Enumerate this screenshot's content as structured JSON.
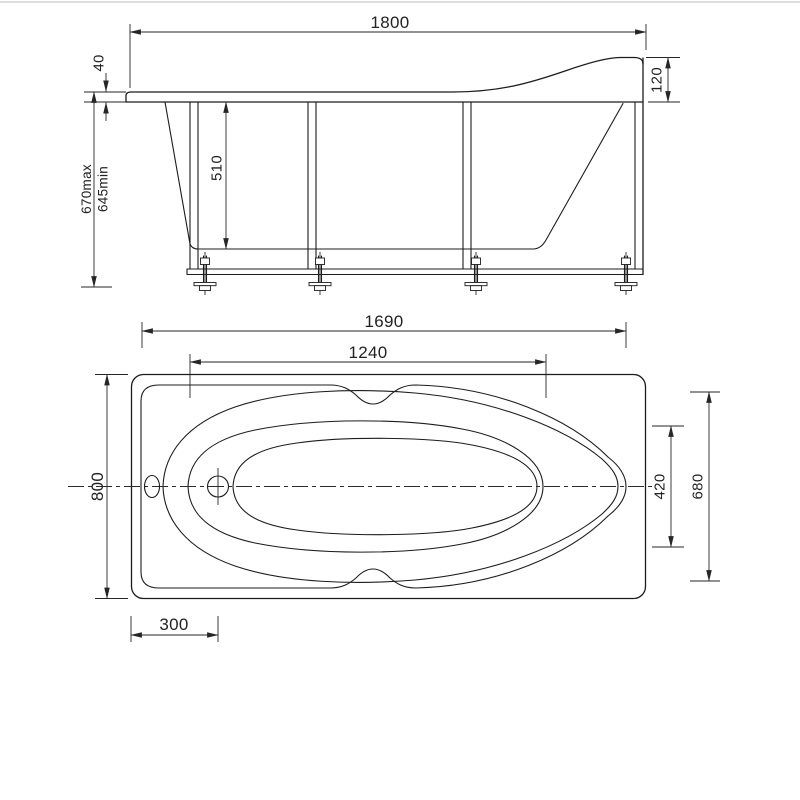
{
  "drawing": {
    "kind": "bathtub installation technical drawing, two orthographic views",
    "colors": {
      "background": "#ffffff",
      "line": "#1c1c1c",
      "dimension": "#262626"
    },
    "side_view": {
      "label": "side elevation with support frame and adjustable feet",
      "dims": {
        "overall_length": "1800",
        "rim_thickness": "40",
        "height_max": "670max",
        "height_min": "645min",
        "inner_height": "510",
        "backrest_rise": "120"
      }
    },
    "top_view": {
      "label": "plan view with basin contours, drain and overflow",
      "dims": {
        "rim_length": "1690",
        "basin_length": "1240",
        "overall_width": "800",
        "basin_width": "420",
        "rim_oval_width": "680",
        "drain_offset": "300"
      }
    }
  }
}
